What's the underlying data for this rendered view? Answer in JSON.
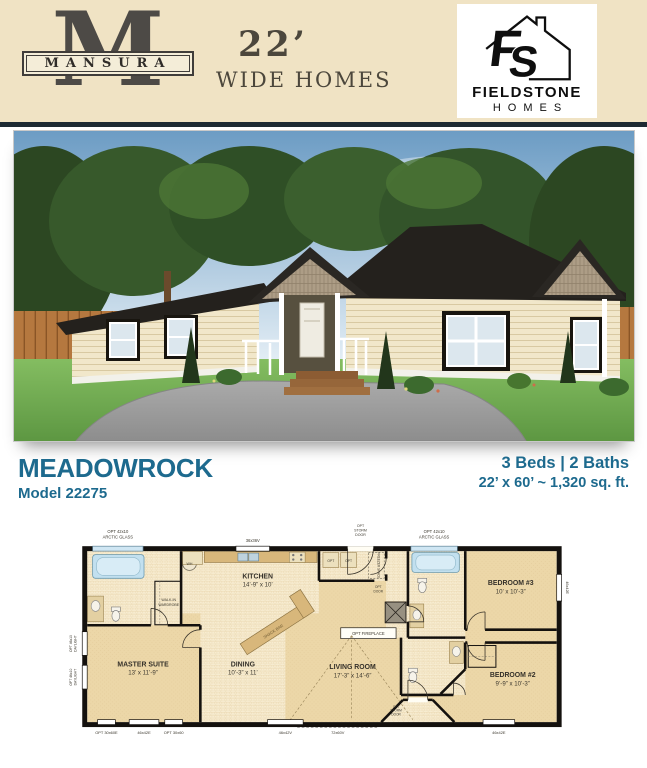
{
  "header": {
    "mansura_monogram": "M",
    "mansura_name": "MANSURA",
    "width_line1": "22’",
    "width_line2": "WIDE HOMES",
    "fieldstone_f": "F",
    "fieldstone_s": "S",
    "fieldstone_name": "FIELDSTONE",
    "fieldstone_homes": "HOMES"
  },
  "model": {
    "name": "MEADOWROCK",
    "number": "Model 22275",
    "beds_baths": "3 Beds  |  2 Baths",
    "size": "22’ x 60’ ~ 1,320 sq. ft."
  },
  "floorplan": {
    "rooms": [
      {
        "name": "MASTER SUITE",
        "size": "13’ x 11’-9”"
      },
      {
        "name": "DINING",
        "size": "10’-3” x 11’"
      },
      {
        "name": "LIVING ROOM",
        "size": "17’-3” x 14’-6”"
      },
      {
        "name": "KITCHEN",
        "size": "14’-9” x 10’"
      },
      {
        "name": "BEDROOM #3",
        "size": "10’ x 10’-3”"
      },
      {
        "name": "BEDROOM #2",
        "size": "9’-9” x 10’-3”"
      }
    ],
    "labels": {
      "arctic_1": "OPT 42x10",
      "arctic_2": "ARCTIC GLASS",
      "storm_1": "OPT",
      "storm_2": "STORM",
      "storm_3": "DOOR",
      "walkin_1": "WALK-IN",
      "walkin_2": "WARDROBE",
      "daylight_1": "OPT 46x10",
      "daylight_2": "DAYLIGHT",
      "optdoor_1": "OPT",
      "optdoor_2": "DOOR",
      "fireplace": "OPT FIREPLACE",
      "snack_bar": "SNACK BAR",
      "freezer": "FREEZER SPACE",
      "wh": "WH",
      "opt": "OPT",
      "win_36x36": "36x36V",
      "win_3060e": "OPT 30x60E",
      "win_4642e": "46x42E",
      "win_3060": "OPT 30x60",
      "win_4642v": "46x42V",
      "win_7260v": "72x60V"
    }
  },
  "colors": {
    "accent_teal": "#1D6A8E",
    "header_bg": "#F0E3C4",
    "divider_navy": "#1D2A33",
    "roof": "#24211D",
    "siding": "#F1E7CA",
    "gable_shakes": "#AD9D86",
    "plan_tile": "#F7ECD1",
    "plan_carpet": "#ECD7A8",
    "fixture_blue": "#C2E0EF"
  }
}
